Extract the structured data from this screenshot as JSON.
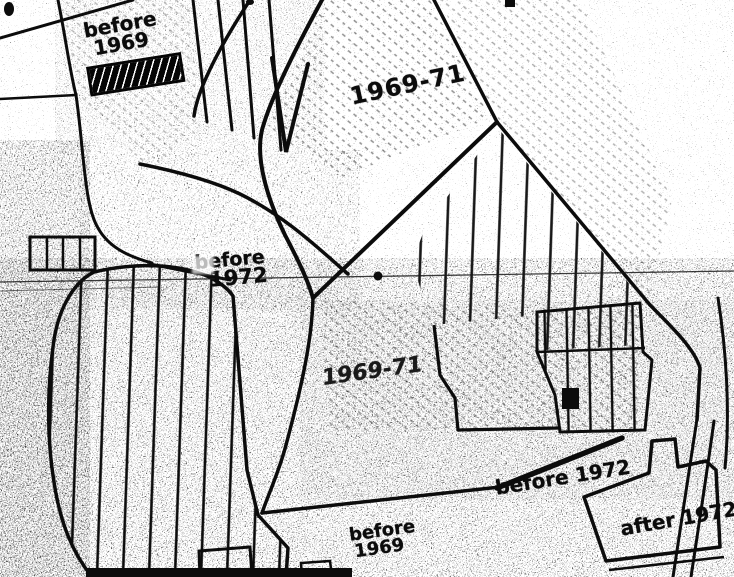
{
  "labels": {
    "top_left": {
      "line1": "before",
      "line2": "1969"
    },
    "top_center": "1969-71",
    "mid_left": {
      "line1": "before",
      "line2": "1972"
    },
    "center": "1969-71",
    "bottom_mid_right": "before 1972",
    "bottom_center": {
      "line1": "before",
      "line2": "1969"
    },
    "bottom_right": "after 1972"
  },
  "colors": {
    "ink": "#0c0c0c",
    "paper": "#ffffff"
  }
}
